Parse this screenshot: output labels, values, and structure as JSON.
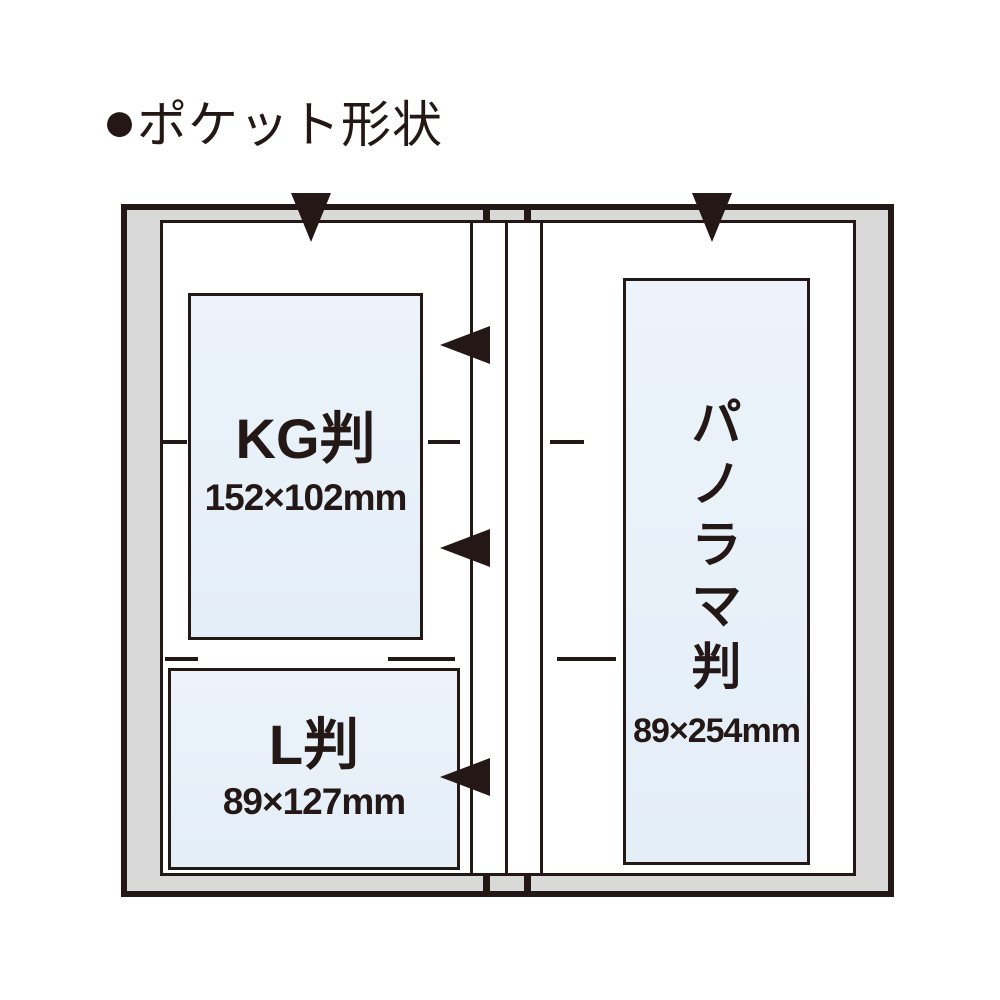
{
  "title": {
    "bullet": "●",
    "text": "ポケット形状"
  },
  "diagram": {
    "description": "open photo album showing pocket shapes",
    "pockets": [
      {
        "id": "kg",
        "label": "KG判",
        "size": "152×102mm"
      },
      {
        "id": "l",
        "label": "L判",
        "size": "89×127mm"
      },
      {
        "id": "panorama",
        "label": "パノラマ判",
        "label_chars": [
          "パ",
          "ノ",
          "ラ",
          "マ",
          "判"
        ],
        "size": "89×254mm"
      }
    ],
    "colors": {
      "line": "#231815",
      "cover_fill": "#d9d9d9",
      "page_fill": "#ffffff",
      "pocket_fill": "#e8f1f9"
    }
  }
}
